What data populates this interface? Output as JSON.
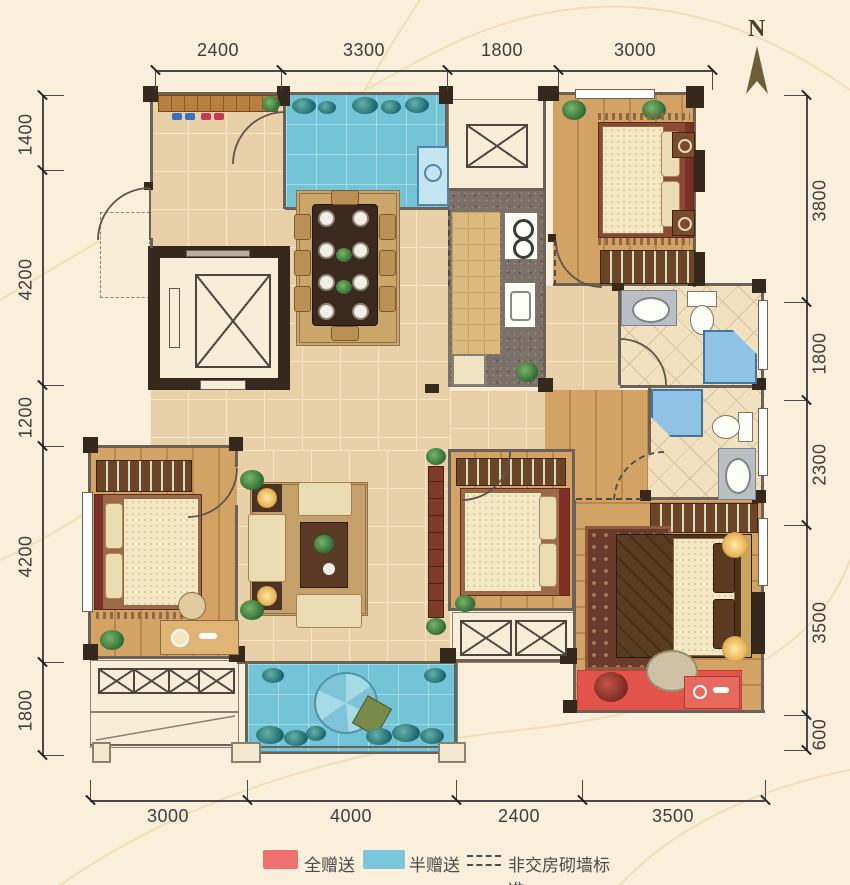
{
  "compass": {
    "label": "N"
  },
  "dimensions": {
    "top": [
      "2400",
      "3300",
      "1800",
      "3000"
    ],
    "bottom": [
      "3000",
      "4000",
      "2400",
      "3500"
    ],
    "left": [
      "1400",
      "4200",
      "1200",
      "4200",
      "1800"
    ],
    "right": [
      "3800",
      "1800",
      "2300",
      "3500",
      "600"
    ]
  },
  "legend": {
    "items": [
      {
        "label": "全赠送",
        "swatch": "red",
        "color": "#ee7170"
      },
      {
        "label": "半赠送",
        "swatch": "blue",
        "color": "#7cc6dd"
      },
      {
        "label": "非交房砌墙标准",
        "swatch": "dashed-line"
      }
    ]
  },
  "colors": {
    "background": "#f9efda",
    "wall": "#37281e",
    "tile_floor": "#e8d1a9",
    "wood_floor": "#d3a365",
    "half_gift_blue": "#73c4d7",
    "full_gift_red": "#e2544b",
    "kitchen_counter": "#7b7168",
    "bath_tile": "#f1e1c1"
  }
}
